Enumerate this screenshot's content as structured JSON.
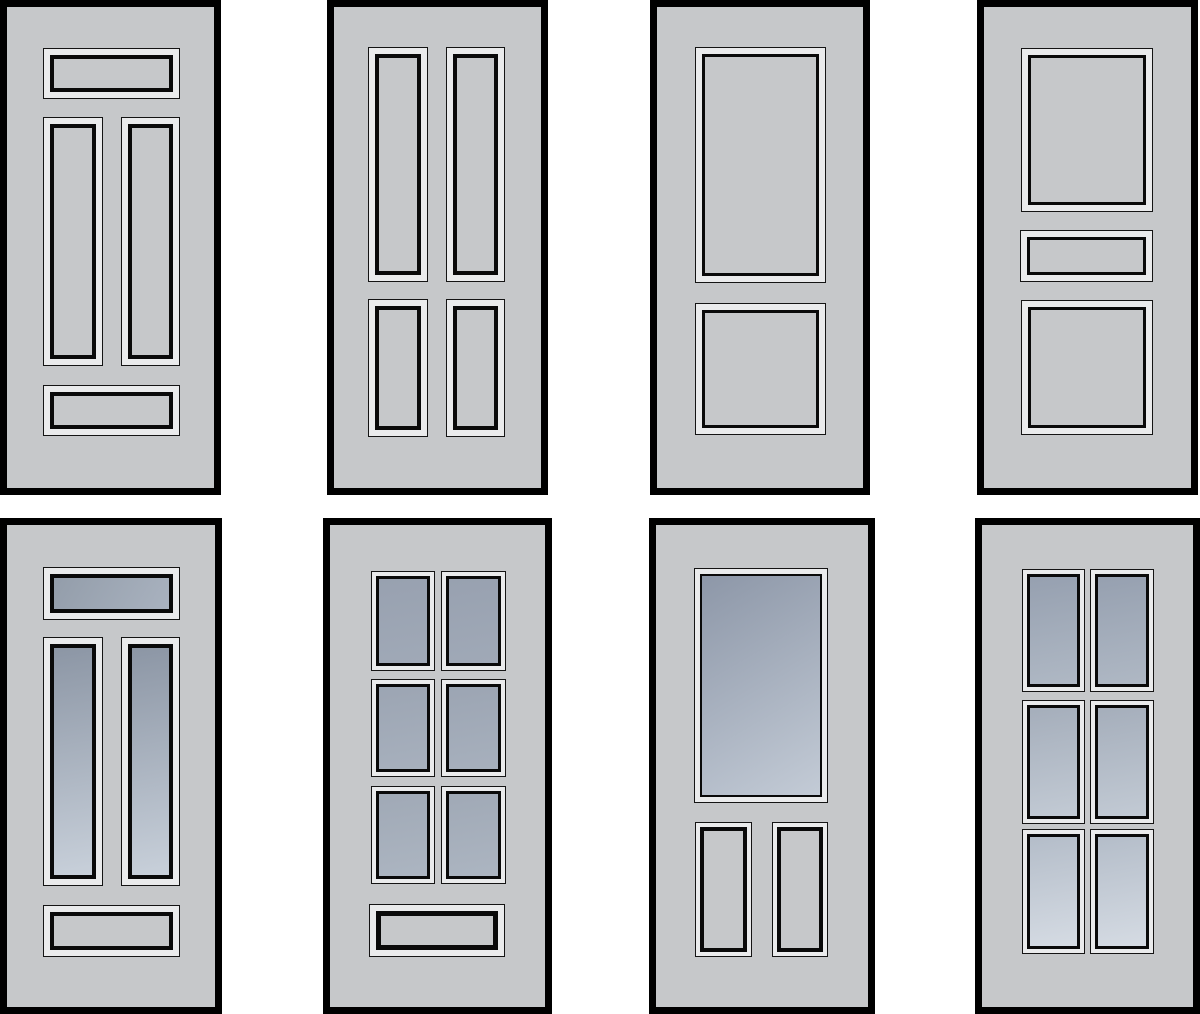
{
  "figure": {
    "title": "Door panel design variations",
    "grid": "4 columns x 2 rows",
    "text_content": "none"
  },
  "colors": {
    "background": "#ffffff",
    "frame": "#000000",
    "door_body": "#c6c8ca",
    "molding_light": "#eaebec",
    "panel_line": "#0a0a0a"
  },
  "glass_gradients": {
    "g5t": {
      "angle": "120deg",
      "from": "#939daa",
      "to": "#a9b2bf"
    },
    "g5v": {
      "angle": "170deg",
      "from": "#8c96a5",
      "to": "#c8d0da"
    },
    "g6r1": {
      "angle": "170deg",
      "from": "#98a1b0",
      "to": "#a0a9b7"
    },
    "g6r2": {
      "angle": "170deg",
      "from": "#9ca5b3",
      "to": "#a7b0bd"
    },
    "g6r3": {
      "angle": "170deg",
      "from": "#a0a9b6",
      "to": "#acb5c1"
    },
    "g7": {
      "angle": "150deg",
      "from": "#8d97a8",
      "to": "#c3cbd6"
    },
    "g8r1": {
      "angle": "170deg",
      "from": "#96a0b0",
      "to": "#afb8c4"
    },
    "g8r2": {
      "angle": "170deg",
      "from": "#a5aebb",
      "to": "#c2cad4"
    },
    "g8r3": {
      "angle": "170deg",
      "from": "#b4bdc9",
      "to": "#d5dbe3"
    }
  },
  "doors": [
    {
      "id": "door-1",
      "row": 1,
      "col": 1,
      "x": 0,
      "y": 0,
      "w": 221,
      "h": 495,
      "description": "five-panel solid: top rail panel, two tall vertical panels, bottom rail panel",
      "panels": [
        {
          "name": "top-panel",
          "kind": "a",
          "x": 36,
          "y": 41,
          "w": 137,
          "h": 51
        },
        {
          "name": "left-vertical-panel",
          "kind": "a",
          "x": 36,
          "y": 110,
          "w": 60,
          "h": 249
        },
        {
          "name": "right-vertical-panel",
          "kind": "a",
          "x": 114,
          "y": 110,
          "w": 59,
          "h": 249
        },
        {
          "name": "bottom-panel",
          "kind": "a",
          "x": 36,
          "y": 378,
          "w": 137,
          "h": 51
        }
      ]
    },
    {
      "id": "door-2",
      "row": 1,
      "col": 2,
      "x": 327,
      "y": 0,
      "w": 221,
      "h": 495,
      "description": "four vertical solid panels: two tall over two short",
      "panels": [
        {
          "name": "upper-left-panel",
          "kind": "a",
          "x": 34,
          "y": 40,
          "w": 60,
          "h": 235
        },
        {
          "name": "upper-right-panel",
          "kind": "a",
          "x": 112,
          "y": 40,
          "w": 59,
          "h": 235
        },
        {
          "name": "lower-left-panel",
          "kind": "a",
          "x": 34,
          "y": 292,
          "w": 60,
          "h": 138
        },
        {
          "name": "lower-right-panel",
          "kind": "a",
          "x": 112,
          "y": 292,
          "w": 59,
          "h": 138
        }
      ]
    },
    {
      "id": "door-3",
      "row": 1,
      "col": 3,
      "x": 650,
      "y": 0,
      "w": 220,
      "h": 495,
      "description": "two-panel solid: large upper panel, square lower panel",
      "panels": [
        {
          "name": "upper-panel",
          "kind": "b",
          "x": 38,
          "y": 40,
          "w": 131,
          "h": 236
        },
        {
          "name": "lower-panel",
          "kind": "b",
          "x": 38,
          "y": 296,
          "w": 131,
          "h": 132
        }
      ]
    },
    {
      "id": "door-4",
      "row": 1,
      "col": 4,
      "x": 977,
      "y": 0,
      "w": 221,
      "h": 495,
      "description": "three-panel solid: large upper panel, narrow mid rail panel, square lower panel",
      "panels": [
        {
          "name": "upper-panel",
          "kind": "b",
          "x": 37,
          "y": 41,
          "w": 132,
          "h": 164
        },
        {
          "name": "mid-rail-panel",
          "kind": "b",
          "x": 36,
          "y": 223,
          "w": 133,
          "h": 52
        },
        {
          "name": "lower-panel",
          "kind": "b",
          "x": 37,
          "y": 293,
          "w": 132,
          "h": 135
        }
      ]
    },
    {
      "id": "door-5",
      "row": 2,
      "col": 1,
      "x": 0,
      "y": 518,
      "w": 222,
      "h": 496,
      "description": "glazed top rail lite and two tall glazed vertical lites, solid bottom rail panel",
      "panels": [
        {
          "name": "top-glass-lite",
          "kind": "a",
          "glass": "g5t",
          "x": 36,
          "y": 42,
          "w": 137,
          "h": 53
        },
        {
          "name": "left-vertical-glass-lite",
          "kind": "a",
          "glass": "g5v",
          "x": 36,
          "y": 112,
          "w": 60,
          "h": 249
        },
        {
          "name": "right-vertical-glass-lite",
          "kind": "a",
          "glass": "g5v",
          "x": 114,
          "y": 112,
          "w": 59,
          "h": 249
        },
        {
          "name": "bottom-panel",
          "kind": "a",
          "x": 36,
          "y": 380,
          "w": 137,
          "h": 52
        }
      ]
    },
    {
      "id": "door-6",
      "row": 2,
      "col": 2,
      "x": 323,
      "y": 518,
      "w": 229,
      "h": 496,
      "description": "six glazed lites in 2x3 grid with solid bottom rail panel",
      "panels": [
        {
          "name": "glass-lite-r1c1",
          "kind": "g",
          "glass": "g6r1",
          "x": 41,
          "y": 46,
          "w": 64,
          "h": 100
        },
        {
          "name": "glass-lite-r1c2",
          "kind": "g",
          "glass": "g6r1",
          "x": 111,
          "y": 46,
          "w": 65,
          "h": 100
        },
        {
          "name": "glass-lite-r2c1",
          "kind": "g",
          "glass": "g6r2",
          "x": 41,
          "y": 154,
          "w": 64,
          "h": 98
        },
        {
          "name": "glass-lite-r2c2",
          "kind": "g",
          "glass": "g6r2",
          "x": 111,
          "y": 154,
          "w": 65,
          "h": 98
        },
        {
          "name": "glass-lite-r3c1",
          "kind": "g",
          "glass": "g6r3",
          "x": 41,
          "y": 261,
          "w": 64,
          "h": 98
        },
        {
          "name": "glass-lite-r3c2",
          "kind": "g",
          "glass": "g6r3",
          "x": 111,
          "y": 261,
          "w": 65,
          "h": 98
        },
        {
          "name": "bottom-panel",
          "kind": "c",
          "x": 39,
          "y": 379,
          "w": 136,
          "h": 53
        }
      ]
    },
    {
      "id": "door-7",
      "row": 2,
      "col": 3,
      "x": 649,
      "y": 518,
      "w": 226,
      "h": 496,
      "description": "half-lite glazed upper panel, two solid vertical lower panels",
      "panels": [
        {
          "name": "upper-glass-lite",
          "kind": "g7",
          "glass": "g7",
          "x": 38,
          "y": 43,
          "w": 134,
          "h": 235
        },
        {
          "name": "lower-left-panel",
          "kind": "d7",
          "x": 39,
          "y": 297,
          "w": 57,
          "h": 135
        },
        {
          "name": "lower-right-panel",
          "kind": "d7",
          "x": 116,
          "y": 297,
          "w": 56,
          "h": 135
        }
      ]
    },
    {
      "id": "door-8",
      "row": 2,
      "col": 4,
      "x": 975,
      "y": 518,
      "w": 225,
      "h": 496,
      "description": "six glazed lites in 2x3 grid, full height glazing",
      "panels": [
        {
          "name": "glass-lite-r1c1",
          "kind": "g",
          "glass": "g8r1",
          "x": 40,
          "y": 44,
          "w": 63,
          "h": 123
        },
        {
          "name": "glass-lite-r1c2",
          "kind": "g",
          "glass": "g8r1",
          "x": 108,
          "y": 44,
          "w": 64,
          "h": 123
        },
        {
          "name": "glass-lite-r2c1",
          "kind": "g",
          "glass": "g8r2",
          "x": 40,
          "y": 175,
          "w": 63,
          "h": 124
        },
        {
          "name": "glass-lite-r2c2",
          "kind": "g",
          "glass": "g8r2",
          "x": 108,
          "y": 175,
          "w": 64,
          "h": 124
        },
        {
          "name": "glass-lite-r3c1",
          "kind": "g",
          "glass": "g8r3",
          "x": 40,
          "y": 304,
          "w": 63,
          "h": 125
        },
        {
          "name": "glass-lite-r3c2",
          "kind": "g",
          "glass": "g8r3",
          "x": 108,
          "y": 304,
          "w": 64,
          "h": 125
        }
      ]
    }
  ]
}
